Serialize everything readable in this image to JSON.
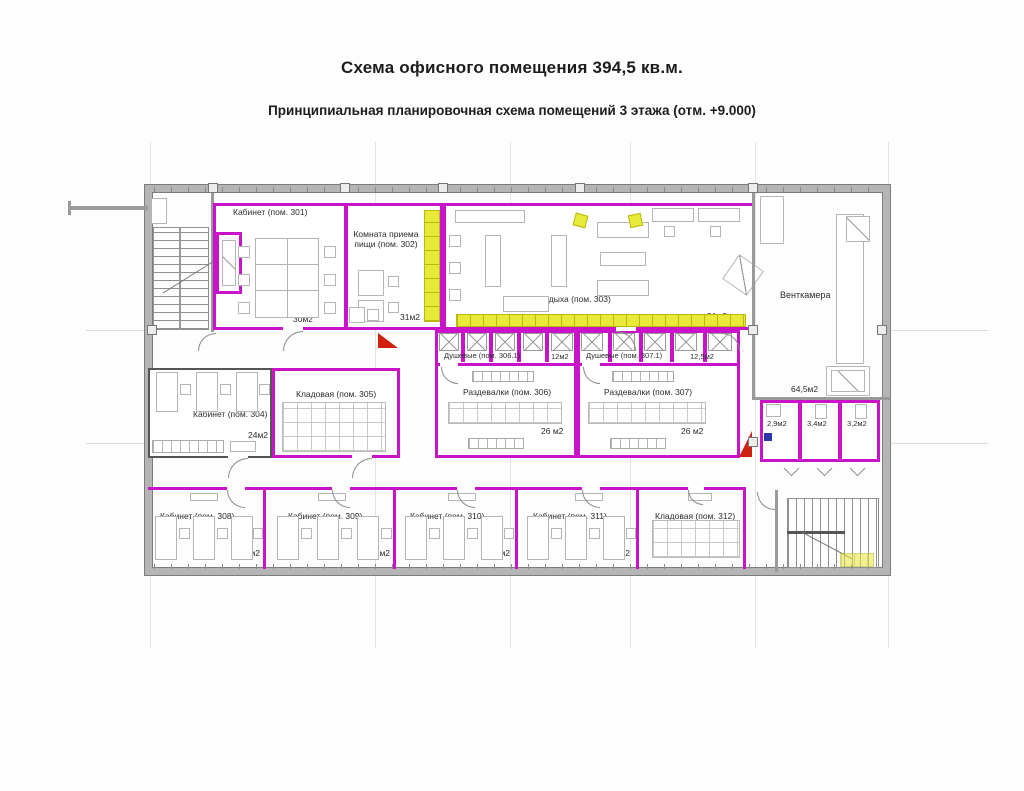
{
  "title": "Схема офисного помещения 394,5 кв.м.",
  "subtitle": "Принципиальная планировочная схема помещений 3 этажа (отм. +9.000)",
  "colors": {
    "room_outline_magenta": "#c913c9",
    "wall_gray": "#b5b5b5",
    "locker_yellow": "#e9e93a",
    "fire_marker_red": "#cf2010"
  },
  "rooms": {
    "r301": {
      "label": "Кабинет (пом. 301)",
      "area": "30м2"
    },
    "r302": {
      "label": "Комната приема пищи (пом. 302)",
      "area": "31м2"
    },
    "r303": {
      "label": "Комната отдыха (пом. 303)",
      "area": "91м2"
    },
    "vent": {
      "label": "Венткамера",
      "area": "64,5м2"
    },
    "r304": {
      "label": "Кабинет (пом. 304)",
      "area": "24м2"
    },
    "r305": {
      "label": "Кладовая (пом. 305)",
      "area": "22м2"
    },
    "r306_1": {
      "label": "Душевые (пом. 306.1)",
      "area": "12м2"
    },
    "r306": {
      "label": "Раздевалки (пом. 306)",
      "area": "26 м2"
    },
    "r307_1": {
      "label": "Душевые (пом. 307.1)",
      "area": "12,5м2"
    },
    "r307": {
      "label": "Раздевалки (пом. 307)",
      "area": "26 м2"
    },
    "wc1": {
      "area": "2,9м2"
    },
    "wc2": {
      "area": "3,4м2"
    },
    "wc3": {
      "area": "3,2м2"
    },
    "r308": {
      "label": "Кабинет (пом. 308)",
      "area": "24м2"
    },
    "r309": {
      "label": "Кабинет (пом. 309)",
      "area": "22м2"
    },
    "r310": {
      "label": "Кабинет (пом. 310)",
      "area": "22м2"
    },
    "r311": {
      "label": "Кабинет (пом. 311)",
      "area": "22м2"
    },
    "r312": {
      "label": "Кладовая (пом. 312)",
      "area": "20,5м2"
    }
  }
}
